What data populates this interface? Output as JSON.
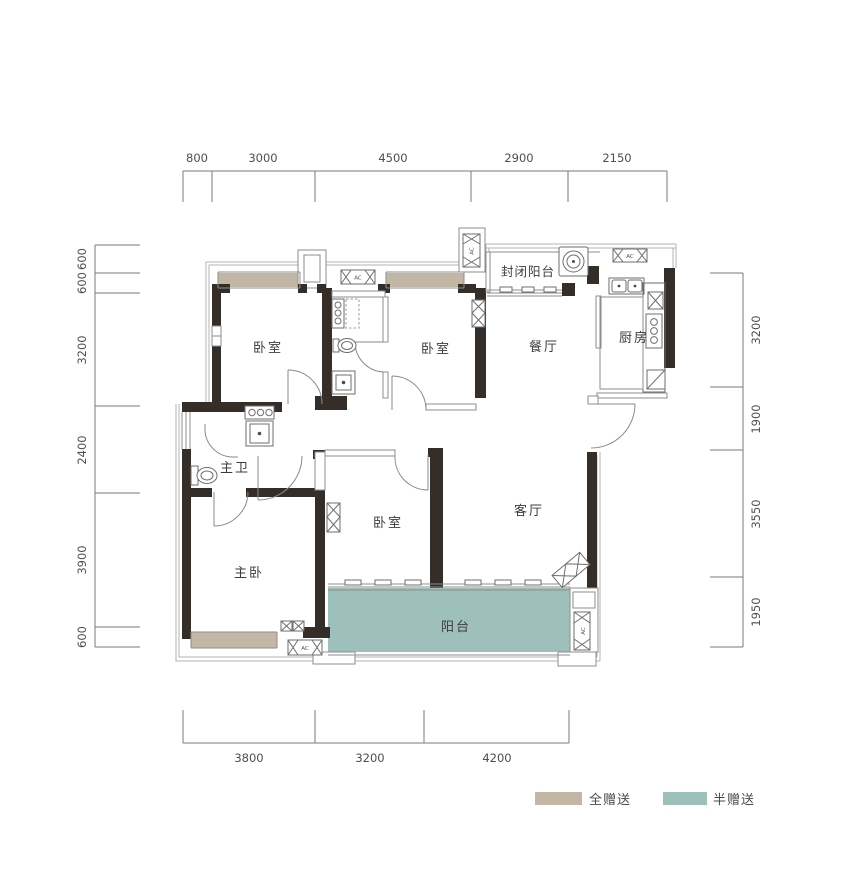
{
  "dimensions": {
    "top": [
      "800",
      "3000",
      "4500",
      "2900",
      "2150"
    ],
    "left": [
      "600",
      "600",
      "3200",
      "2400",
      "3900",
      "600"
    ],
    "right": [
      "3200",
      "1900",
      "3550",
      "1950"
    ],
    "bottom": [
      "3800",
      "3200",
      "4200"
    ]
  },
  "rooms": {
    "bedroom_top_left": "卧室",
    "bedroom_top_middle": "卧室",
    "dining_room": "餐厅",
    "kitchen": "厨房",
    "enclosed_balcony": "封闭阳台",
    "master_bathroom": "主卫",
    "master_bedroom": "主卧",
    "bedroom_bottom": "卧室",
    "living_room": "客厅",
    "balcony": "阳台"
  },
  "labels": {
    "ac_unit": "AC"
  },
  "legend": {
    "full_gift": {
      "label": "全赠送",
      "color": "#c2b6a4"
    },
    "half_gift": {
      "label": "半赠送",
      "color": "#9ec0ba"
    }
  },
  "colors": {
    "wall": "#352d27",
    "line": "#8d8d8d",
    "text": "#3c3c3c"
  }
}
